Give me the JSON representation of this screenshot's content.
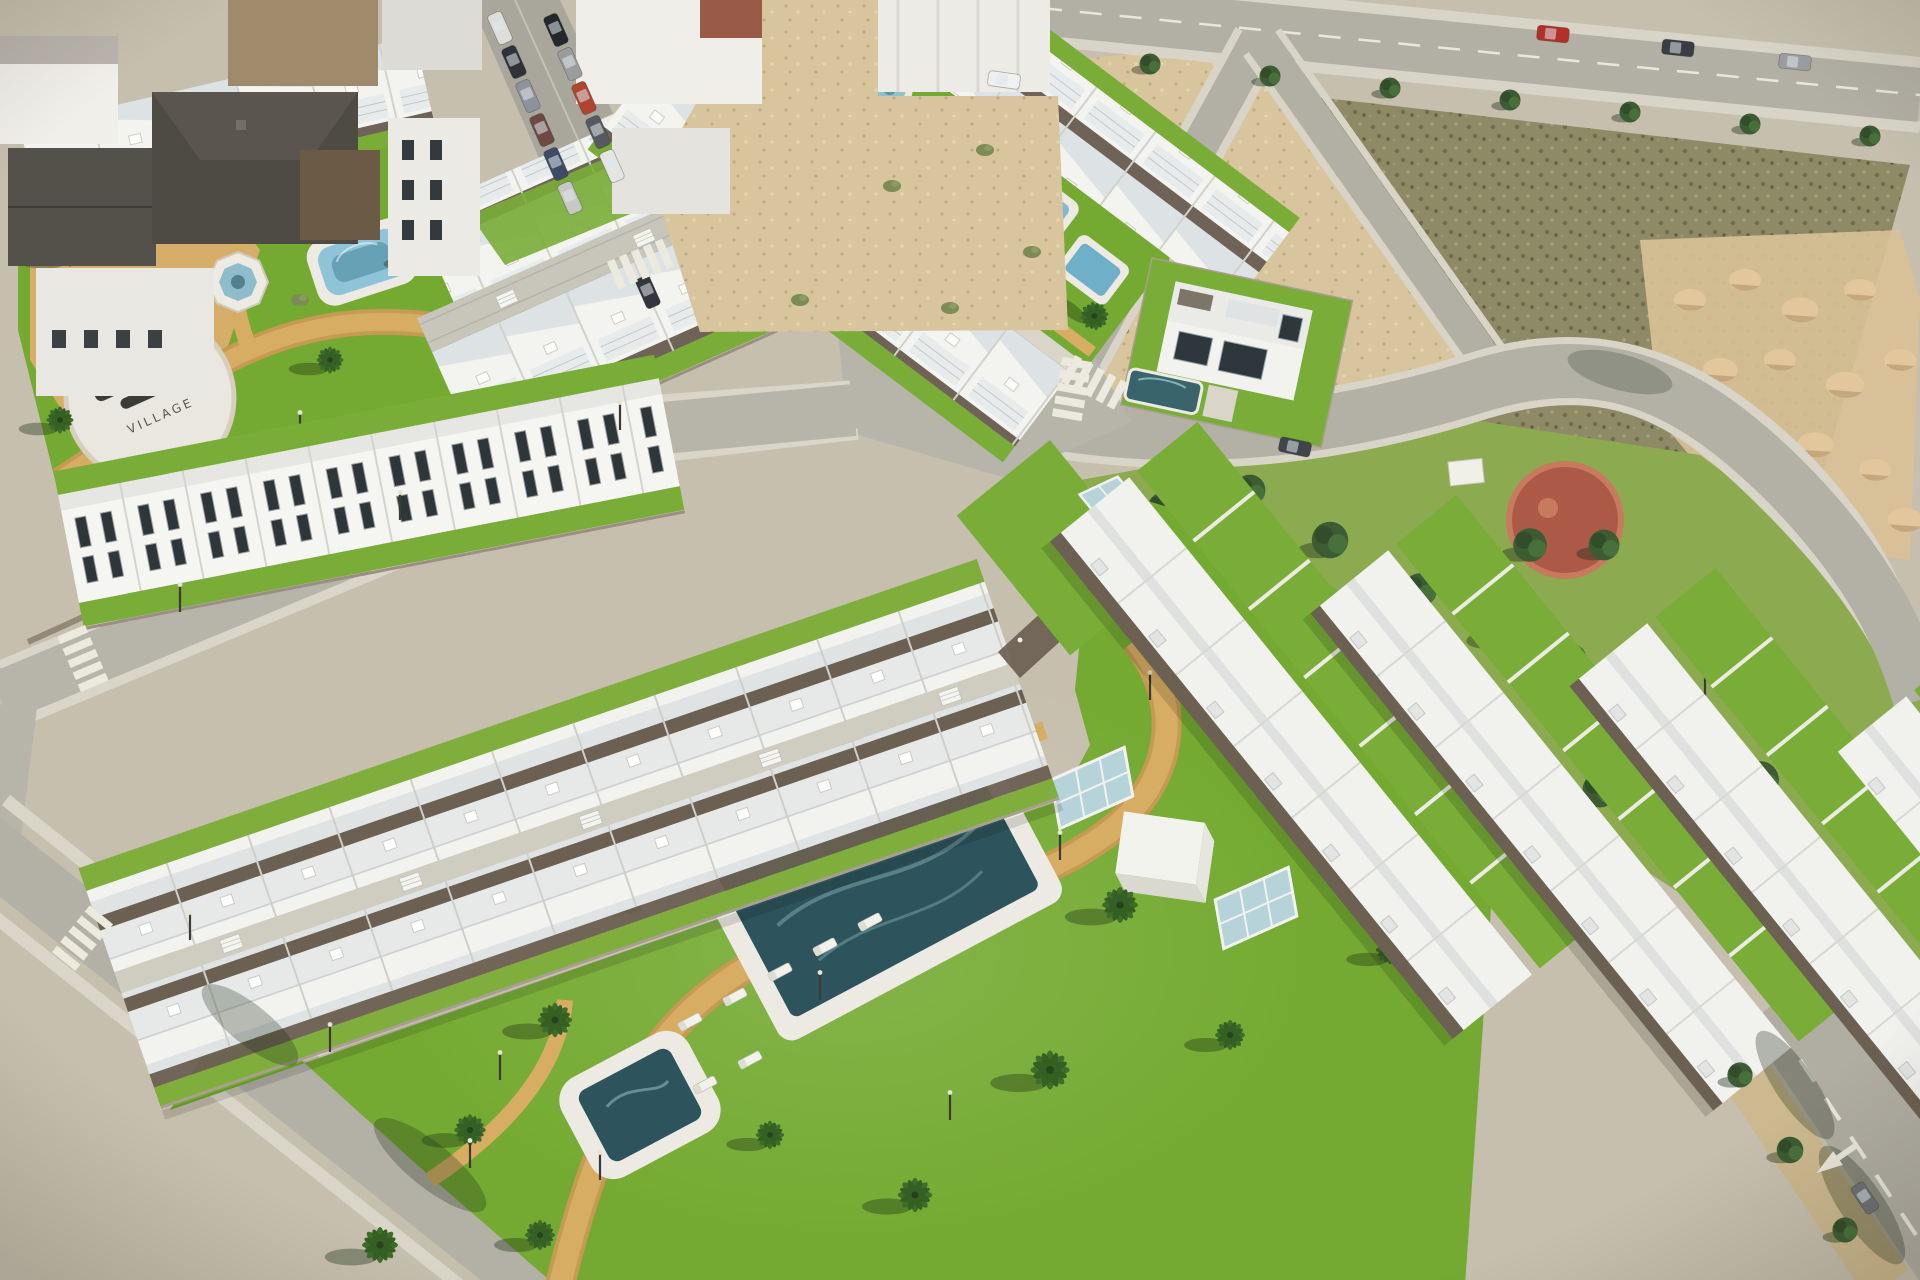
{
  "scene": {
    "description": "Aerial 3D architectural render of a white Mediterranean residential development: rows of modern townhouses and apartment blocks with brown pergola terraces around landscaped communal gardens with swimming pools, palm trees and ochre paths; bordered by an existing town block, roads with crosswalks, a public park with a playground, and vacant scrub plots with sand stockpiles.",
    "ground_logo_text": "VILLAGE",
    "areas": {
      "existing_town": "old town block with dark roofs and parked cars",
      "development_a": "first phase townhouse rows with communal garden, round fountain, lap pool and kids pool",
      "development_b": "second phase apartment rows with large communal garden, main pool, children's pool and sun loungers",
      "detached_villa": "two-storey villa with private pool",
      "public_park": "pine park with circular playground and utility hut",
      "vacant_plot": "unbuilt scrub plot with sand stockpiles",
      "roads": "perimeter streets with crosswalks, street lamps and lane arrow"
    },
    "features": [
      "logo-plaza",
      "round-fountain",
      "octagon-fountain",
      "rounded-pool",
      "lap-pool",
      "kids-pool",
      "main-pool",
      "children-pool",
      "sun-loungers",
      "pool-kiosk-cube",
      "glass-skylights",
      "pergola-terraces",
      "palm-trees",
      "pine-trees",
      "playground",
      "sand-stockpiles",
      "crosswalks",
      "street-lamps",
      "lane-arrow",
      "parked-cars",
      "red-car",
      "white-pickup"
    ],
    "counts": {
      "sun_loungers": 7,
      "glass_skylights": 4,
      "water_features": 8,
      "parked_cars_town_street": 11,
      "crosswalks": 5,
      "playgrounds": 1
    }
  },
  "palette": {
    "grass": "#74aa31",
    "grass_light": "#8cab50",
    "path_tan": "#d7ad63",
    "road_asphalt": "#b3b0a6",
    "sidewalk": "#d9d5c9",
    "concrete_lane": "#c8c5ba",
    "dirt": "#d8c59e",
    "scrub": "#8f8a66",
    "sand": "#e3c79c",
    "building_white": "#f3f3f0",
    "roof_shade": "#dde2e4",
    "pergola_brown": "#6b6052",
    "stone_wall": "#9a8f82",
    "water_light": "#8fc3d8",
    "water_dark": "#2d545c",
    "tree_green": "#3d5c33",
    "palm_green": "#3f6b2b",
    "playground_red": "#ad5948",
    "logo_dark": "#3c3c36",
    "red_car": "#b23026"
  }
}
